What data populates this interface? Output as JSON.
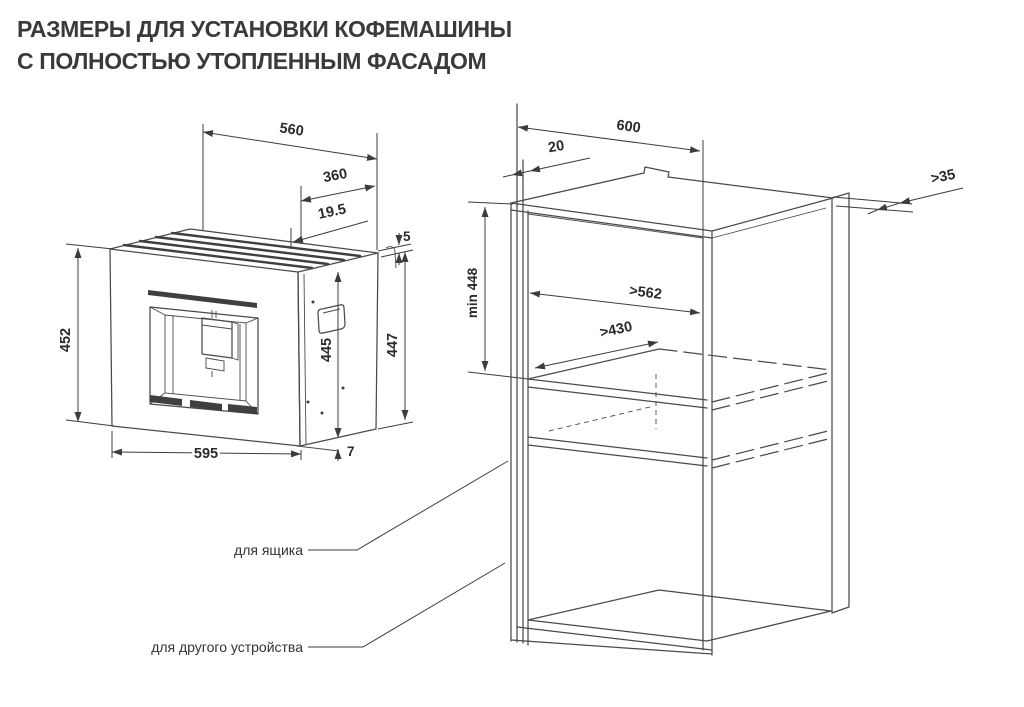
{
  "title": {
    "line1": "РАЗМЕРЫ ДЛЯ УСТАНОВКИ КОФЕМАШИНЫ",
    "line2": "С ПОЛНОСТЬЮ УТОПЛЕННЫМ ФАСАДОМ"
  },
  "machine": {
    "dims": {
      "top_width": "560",
      "depth": "360",
      "front_offset": "19.5",
      "top_gap": "5",
      "front_height": "452",
      "body_height": "445",
      "side_height": "447",
      "front_width": "595",
      "bottom_gap": "7"
    }
  },
  "cabinet": {
    "dims": {
      "depth": "600",
      "front_gap": "20",
      "wall_clearance": ">35",
      "niche_height": "min 448",
      "niche_width": ">562",
      "shelf_depth": ">430"
    },
    "labels": {
      "drawer": "для ящика",
      "other_device": "для другого устройства"
    }
  },
  "colors": {
    "line": "#4a4a4a",
    "dim_text": "#2b2b2b",
    "title_text": "#3a3a3a",
    "background": "#ffffff"
  }
}
